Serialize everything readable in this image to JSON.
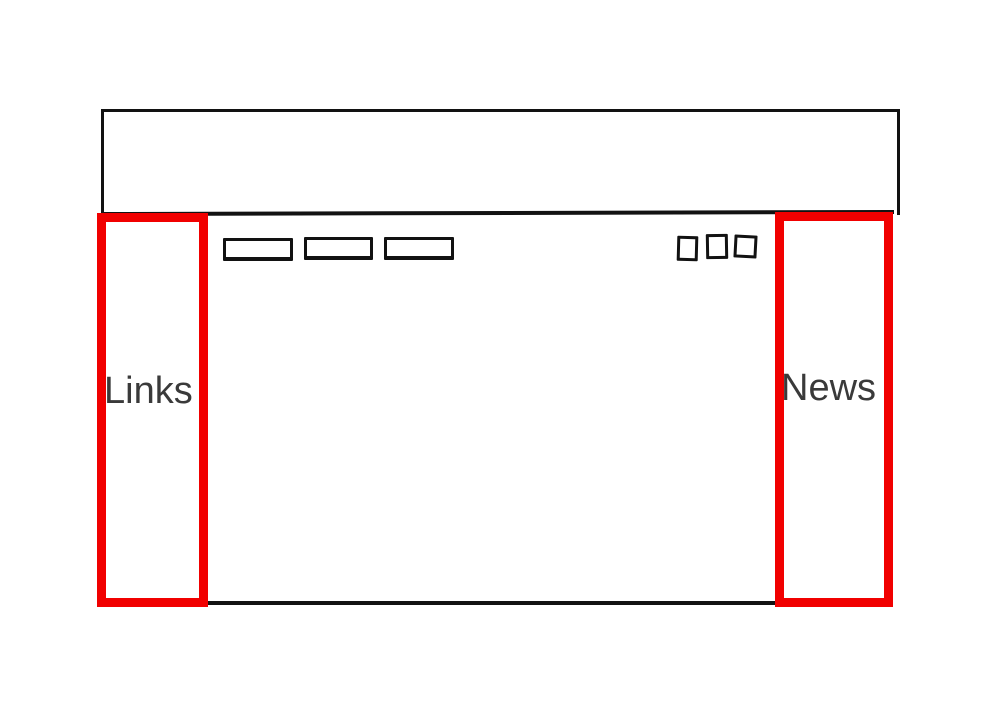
{
  "wireframe": {
    "left_sidebar": {
      "label": "Links"
    },
    "right_sidebar": {
      "label": "News"
    },
    "header": {
      "nav_button_placeholders": {
        "count": 3,
        "shape": "empty-rectangle"
      },
      "square_placeholders": {
        "count": 3,
        "shape": "empty-square"
      }
    }
  },
  "colors": {
    "annotation_red": "#f10000",
    "sketch_stroke": "#121212",
    "label_text": "#3a3a3a",
    "background": "#ffffff"
  }
}
